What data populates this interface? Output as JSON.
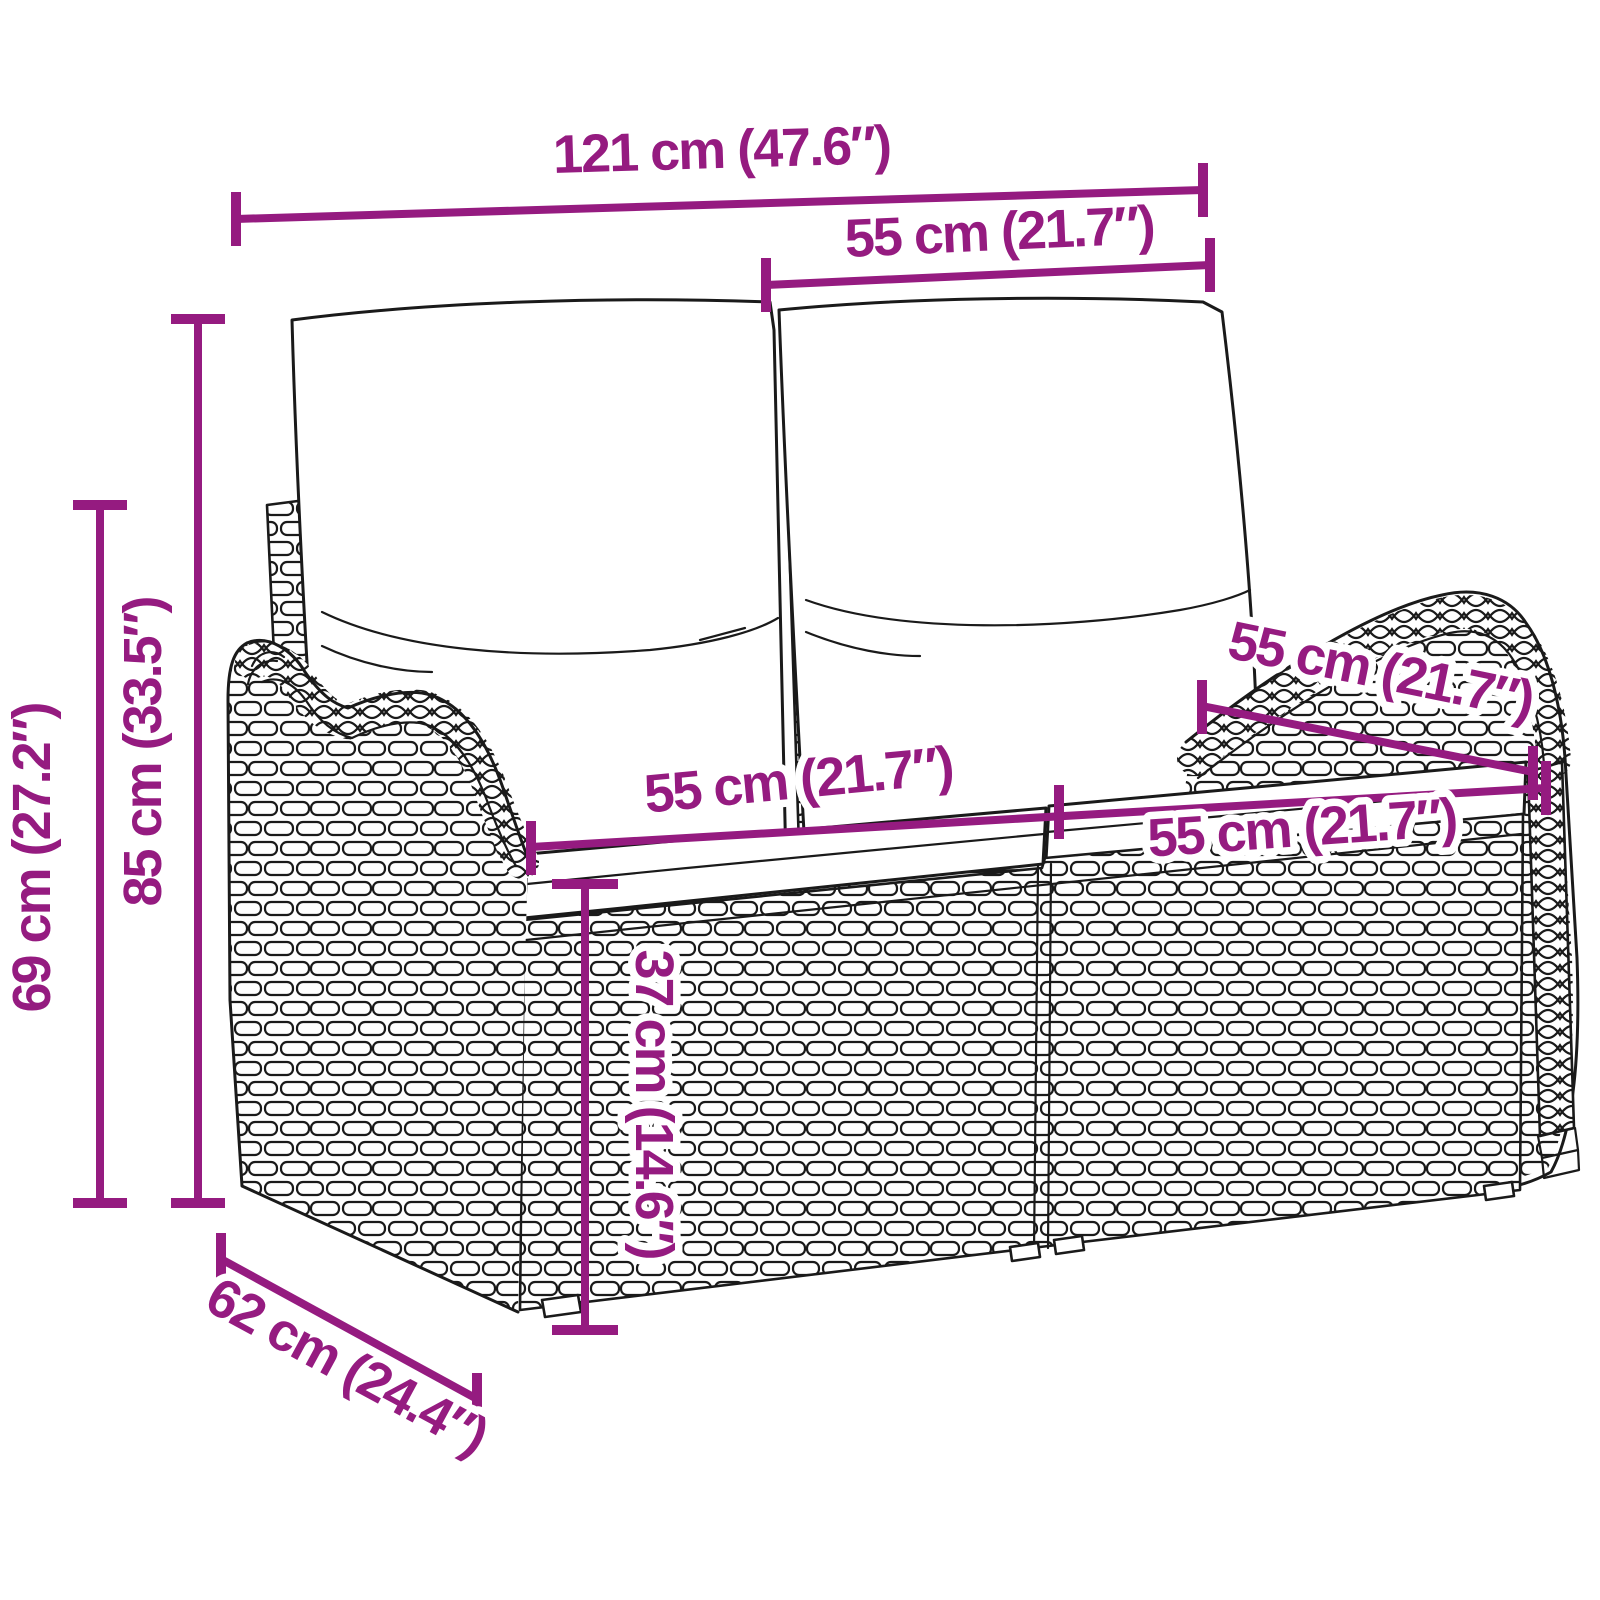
{
  "page": {
    "type": "product-dimension-diagram",
    "subject": "2-seater poly rattan garden bench with back and seat cushions",
    "background": "#FFFFFF"
  },
  "colors": {
    "dimension_accent": "#951B80",
    "line_art_outline": "#1A1A1A",
    "cushion_fill": "#FFFFFF"
  },
  "dimensions": {
    "overall_width": {
      "label": "121 cm (47.6″)"
    },
    "backrest_width": {
      "label": "55 cm (21.7″)"
    },
    "armrest_height": {
      "label": "69 cm (27.2″)"
    },
    "overall_height": {
      "label": "85 cm (33.5″)"
    },
    "seat_width_left": {
      "label": "55 cm (21.7″)"
    },
    "seat_width_right": {
      "label": "55 cm (21.7″)"
    },
    "seat_depth": {
      "label": "55 cm (21.7″)"
    },
    "seat_height": {
      "label": "37 cm (14.6″)"
    },
    "overall_depth": {
      "label": "62 cm (24.4″)"
    }
  }
}
